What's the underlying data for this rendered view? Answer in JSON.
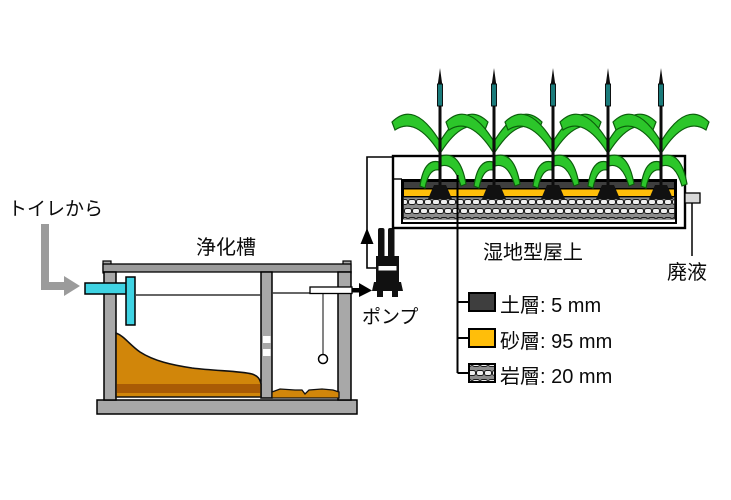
{
  "labels": {
    "from_toilet": "トイレから",
    "septic_tank": "浄化槽",
    "pump": "ポンプ",
    "wetland_rooftop": "湿地型屋上",
    "waste_liquid": "廃液"
  },
  "legend": {
    "items": [
      {
        "id": "soil",
        "name": "土層",
        "thickness_mm": 5,
        "text": "土層: 5 mm",
        "swatch_color": "#3E3E3E"
      },
      {
        "id": "sand",
        "name": "砂層",
        "thickness_mm": 95,
        "text": "砂層: 95 mm",
        "swatch_color": "#FFBE0A"
      },
      {
        "id": "rock",
        "name": "岩層",
        "thickness_mm": 20,
        "text": "岩層: 20 mm",
        "swatch_style": "gravel-pattern"
      }
    ]
  },
  "system": {
    "plant_count": 5
  },
  "colors": {
    "inlet_pipe_cyan": "#3FD3E3",
    "sludge_amber": "#D1860A",
    "sludge_dark": "#A95B05",
    "structure_gray": "#A8A8A8",
    "arrow_gray": "#9B9B9B",
    "soil_dark_gray": "#3E3E3E",
    "sand_yellow": "#FFBE0A",
    "leaf_green": "#2CC62A",
    "stem_teal": "#1B7B7B"
  }
}
